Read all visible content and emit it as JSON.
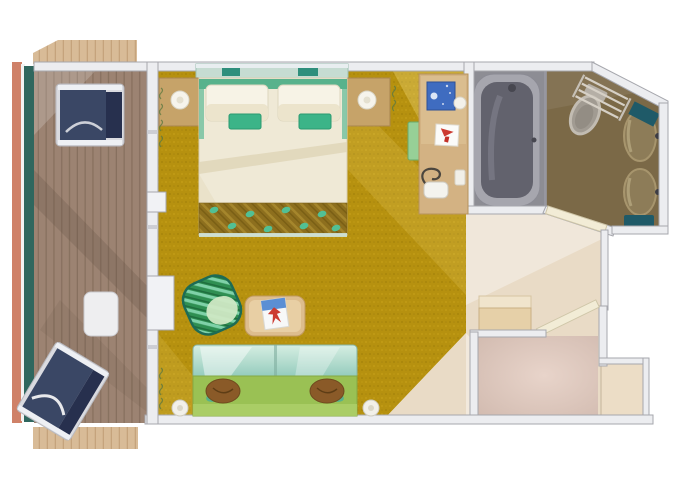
{
  "page": {
    "type": "cruise-stateroom-floorplan",
    "background": "#ffffff"
  },
  "palette": {
    "background": "#ffffff",
    "hull_strip": "#cf8168",
    "railing_teal": "#2f675e",
    "deck_wood": "#9c8372",
    "deck_plank_line": "#87705f",
    "deck_wood_light": "#d8bb97",
    "deck_light_line": "#c5a37c",
    "wall_fill": "#ecedf0",
    "wall_edge": "#a6a7ad",
    "carpet_gold": "#b6910f",
    "carpet_speck_dark": "#a8850b",
    "carpet_speck_light": "#c29c16",
    "bed_linen": "#efe9d6",
    "pillow_white": "#f7f3e6",
    "towel_green": "#3cb488",
    "headboard_teal": "#2f8f7c",
    "runner_gold": "#8d6f1e",
    "runner_accent": "#52c094",
    "nightstand_wood": "#c6a369",
    "desk_wood": "#d3b283",
    "tv_blue": "#3f6cc0",
    "logo_red": "#cc3a30",
    "magazine_blue": "#5b8fd4",
    "bench_green": "#97d097",
    "lounger_navy": "#3a4765",
    "lounger_frame": "#dadbe0",
    "armchair_stripe_dark": "#2f8f52",
    "armchair_stripe_light": "#7fd1a8",
    "armchair_rim": "#1d6b55",
    "armchair_seat": "#cfe8c4",
    "sofa_seat_green": "#9ac154",
    "sofa_back_glass": "#8fc9ba",
    "cushion_brown": "#8a5a28",
    "table_wood": "#ddbd8e",
    "tub_room_floor": "#8d8d94",
    "tub_rim": "#a6a6ae",
    "tub_basin": "#62626d",
    "bath_floor_brown": "#7b6947",
    "toilet_gray": "#a19b92",
    "sink_tan": "#8d7c58",
    "accent_dark_teal": "#1f5a68",
    "hall_floor": "#e9dbc6",
    "vestibule_floor": "#d8c2b8",
    "closet_tan": "#e6d0a8",
    "door_cream": "#f2ecd6"
  },
  "floorplan": {
    "rooms": [
      {
        "id": "balcony",
        "furniture": [
          "lounge-chair-top",
          "side-table",
          "lounge-chair-bottom",
          "railing",
          "deck-extension-top",
          "deck-extension-bottom"
        ]
      },
      {
        "id": "bedroom-living",
        "furniture": [
          "double-bed",
          "pillow",
          "pillow",
          "towel",
          "towel",
          "bed-runner",
          "nightstand-left",
          "lamp",
          "nightstand-right",
          "lamp",
          "desk",
          "desk-bench",
          "tv",
          "logo-card",
          "hairdryer",
          "bottle",
          "armchair",
          "coffee-table",
          "magazine",
          "sofa",
          "cushion",
          "cushion",
          "wall-lamp",
          "wall-lamp",
          "balcony-door"
        ]
      },
      {
        "id": "bathroom",
        "furniture": [
          "bathtub",
          "faucet",
          "toilet",
          "towel-rack",
          "sink",
          "sink",
          "towel-shelf",
          "towel-shelf",
          "bathroom-door"
        ]
      },
      {
        "id": "entry-hall",
        "furniture": [
          "luggage-bench",
          "entry-door",
          "closet",
          "vestibule"
        ]
      }
    ]
  }
}
